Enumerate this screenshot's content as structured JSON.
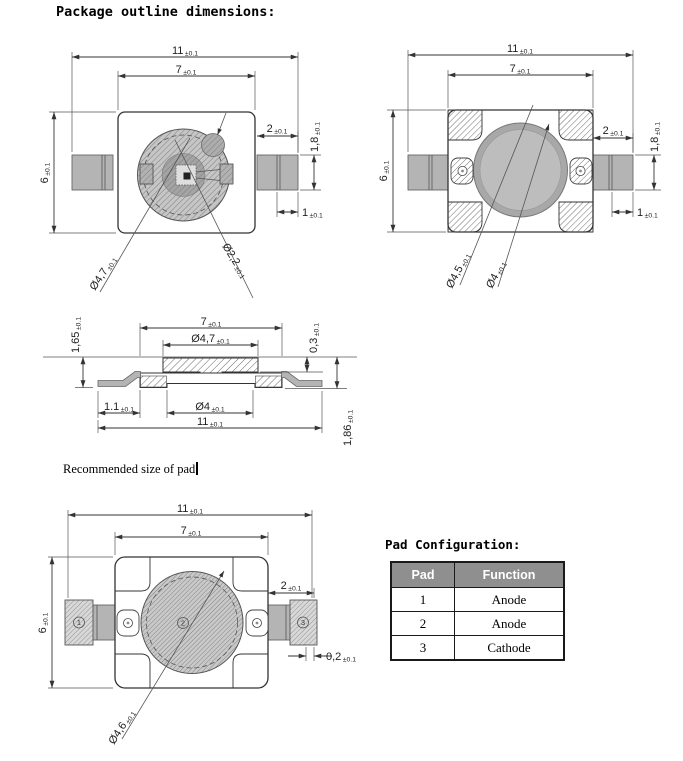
{
  "title": "Package outline dimensions:",
  "tol": "±0.1",
  "note": "Recommended size of pad",
  "view1": {
    "w11": "11",
    "w7": "7",
    "h6": "6",
    "w2": "2",
    "h18": "1,8",
    "w1": "1",
    "dia_lens": "Ø4,7",
    "dia_inner": "Ø2,2"
  },
  "view2": {
    "w11": "11",
    "w7": "7",
    "h6": "6",
    "w2": "2",
    "h18": "1,8",
    "w1": "1",
    "dia_outer": "Ø4,5",
    "dia_inner": "Ø4"
  },
  "view3": {
    "h165": "1,65",
    "w7": "7",
    "dia47": "Ø4,7",
    "h03": "0,3",
    "w11dot1": "1.1",
    "dia4": "Ø4",
    "w11": "11",
    "h186": "1,86"
  },
  "view4": {
    "w11": "11",
    "w7": "7",
    "h6": "6",
    "w2": "2",
    "w02": "0,2",
    "dia46": "Ø4,6"
  },
  "pads": {
    "p1": "1",
    "p2": "2",
    "p3": "3"
  },
  "pad_table": {
    "title": "Pad Configuration:",
    "headers": [
      "Pad",
      "Function"
    ],
    "rows": [
      [
        "1",
        "Anode"
      ],
      [
        "2",
        "Anode"
      ],
      [
        "3",
        "Cathode"
      ]
    ]
  }
}
